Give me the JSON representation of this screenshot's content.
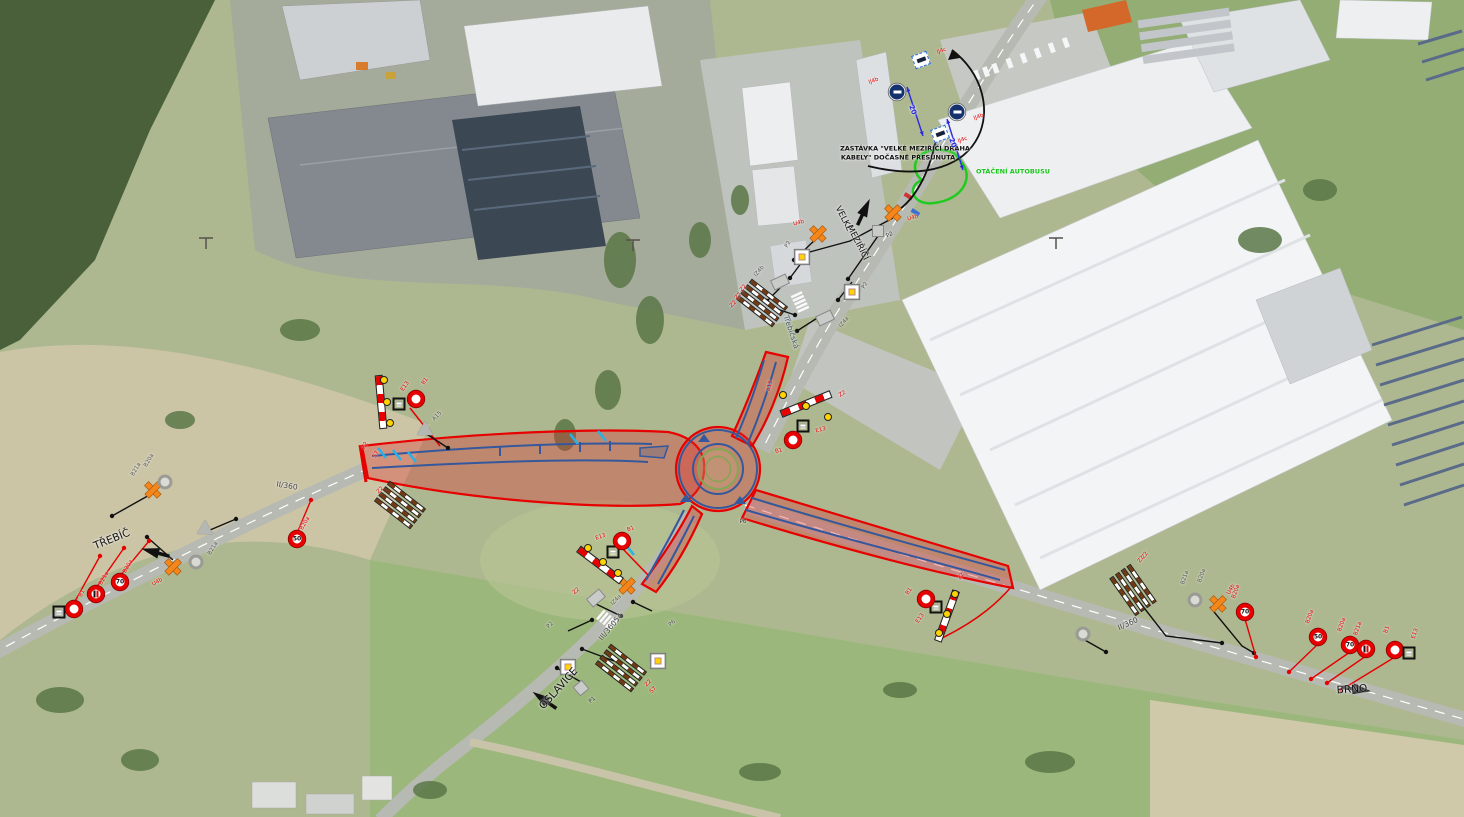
{
  "map": {
    "notes": {
      "bus_stop_line1": "ZASTÁVKA \"VELKÉ MEZIŘÍČÍ DRÁHA",
      "bus_stop_line2": "KABELY\" DOČASNĚ PŘESUNUTA",
      "bus_turning": "OTÁČENÍ AUTOBUSU"
    },
    "destinations": {
      "west": "TŘEBÍČ",
      "south": "OSLAVICE",
      "east": "BRNO",
      "north_line1": "VELKÉ",
      "north_line2": "MEZIŘÍČÍ"
    },
    "roads": {
      "west": "II/360",
      "east": "II/360",
      "south": "III/36054",
      "street": "Třebíčská"
    },
    "dimension_value": "20",
    "colors": {
      "closure_zone": "#e60000",
      "lane_marking": "#35589c",
      "temp_device": "#f5861c",
      "bus_note": "#16c518"
    }
  },
  "labels": [
    {
      "t": "ZASTÁVKA \"VELKÉ MEZIŘÍČÍ DRÁHA",
      "x": 905,
      "y": 149,
      "r": 0,
      "c": "#111",
      "f": 6.5,
      "w": 700
    },
    {
      "t": "KABELY\" DOČASNĚ PŘESUNUTA",
      "x": 898,
      "y": 158,
      "r": 0,
      "c": "#111",
      "f": 6.5,
      "w": 700
    },
    {
      "t": "OTÁČENÍ AUTOBUSU",
      "x": 1013,
      "y": 172,
      "r": 0,
      "c": "#16c518",
      "f": 6.5,
      "w": 700
    },
    {
      "t": "VELKÉ",
      "x": 843,
      "y": 219,
      "r": 63,
      "c": "#111",
      "f": 8.5,
      "w": 400
    },
    {
      "t": "MEZIŘÍČÍ",
      "x": 857,
      "y": 243,
      "r": 63,
      "c": "#111",
      "f": 8.5,
      "w": 400
    },
    {
      "t": "Třebíčská",
      "x": 791,
      "y": 332,
      "r": 72,
      "c": "#45566b",
      "f": 7.5,
      "w": 400
    },
    {
      "t": "TŘEBÍČ",
      "x": 112,
      "y": 540,
      "r": -22,
      "c": "#111",
      "f": 10.5,
      "w": 400
    },
    {
      "t": "OSLAVICE",
      "x": 559,
      "y": 689,
      "r": -48,
      "c": "#111",
      "f": 10.5,
      "w": 400
    },
    {
      "t": "BRNO",
      "x": 1352,
      "y": 690,
      "r": -4,
      "c": "#111",
      "f": 10.5,
      "w": 400
    },
    {
      "t": "II/360",
      "x": 287,
      "y": 486,
      "r": 9,
      "c": "#444",
      "f": 7.5,
      "w": 400
    },
    {
      "t": "II/360",
      "x": 1128,
      "y": 624,
      "r": -24,
      "c": "#444",
      "f": 7.5,
      "w": 400
    },
    {
      "t": "III/36054",
      "x": 611,
      "y": 627,
      "r": -50,
      "c": "#444",
      "f": 7.5,
      "w": 400
    },
    {
      "t": "20",
      "x": 912,
      "y": 110,
      "r": 70,
      "c": "#2a2ae0",
      "f": 7,
      "w": 700
    },
    {
      "t": "20",
      "x": 952,
      "y": 143,
      "r": 70,
      "c": "#2a2ae0",
      "f": 7,
      "w": 700
    },
    {
      "t": "P2",
      "x": 890,
      "y": 236,
      "r": -25,
      "c": "#333",
      "f": 5.5,
      "w": 400
    },
    {
      "t": "P6",
      "x": 743,
      "y": 523,
      "r": 0,
      "c": "#333",
      "f": 5.5,
      "w": 400
    },
    {
      "t": "P1",
      "x": 593,
      "y": 701,
      "r": -40,
      "c": "#333",
      "f": 5.5,
      "w": 400
    },
    {
      "t": "S7",
      "x": 377,
      "y": 455,
      "r": -60,
      "c": "#e60000",
      "f": 5.5,
      "w": 400
    },
    {
      "t": "A15",
      "x": 771,
      "y": 386,
      "r": -80,
      "c": "#e60000",
      "f": 5.5,
      "w": 400
    },
    {
      "t": "B20a",
      "x": 150,
      "y": 461,
      "r": -60,
      "c": "#555",
      "f": 5.5,
      "w": 400
    },
    {
      "t": "B21a",
      "x": 137,
      "y": 470,
      "r": -60,
      "c": "#555",
      "f": 5.5,
      "w": 400
    },
    {
      "t": "B21a",
      "x": 214,
      "y": 549,
      "r": -60,
      "c": "#555",
      "f": 5.5,
      "w": 400
    },
    {
      "t": "B21a",
      "x": 1186,
      "y": 578,
      "r": -70,
      "c": "#555",
      "f": 5.5,
      "w": 400
    },
    {
      "t": "B20a",
      "x": 1203,
      "y": 576,
      "r": -70,
      "c": "#555",
      "f": 5.5,
      "w": 400
    },
    {
      "t": "Z2",
      "x": 739,
      "y": 297,
      "r": -45,
      "c": "#e60000",
      "f": 5.5,
      "w": 400
    },
    {
      "t": "Z2",
      "x": 734,
      "y": 305,
      "r": -45,
      "c": "#e60000",
      "f": 5.5,
      "w": 400
    },
    {
      "t": "Z2",
      "x": 1146,
      "y": 556,
      "r": -55,
      "c": "#e60000",
      "f": 5.5,
      "w": 400
    },
    {
      "t": "S7",
      "x": 654,
      "y": 691,
      "r": -45,
      "c": "#e60000",
      "f": 5.5,
      "w": 400
    }
  ],
  "signs": [
    {
      "t": "ij4c",
      "x": 921,
      "y": 60,
      "r": -20,
      "l": "IJ4c",
      "lx": 942,
      "ly": 52,
      "lr": -20,
      "lc": "#e60000"
    },
    {
      "t": "ij4b",
      "x": 897,
      "y": 92,
      "l": "IJ4b",
      "lx": 874,
      "ly": 82,
      "lr": -20,
      "lc": "#e60000"
    },
    {
      "t": "ij4b",
      "x": 957,
      "y": 112,
      "l": "IJ4b",
      "lx": 979,
      "ly": 118,
      "lr": -20,
      "lc": "#e60000"
    },
    {
      "t": "ij4c",
      "x": 940,
      "y": 134,
      "r": -20,
      "l": "IJ4c",
      "lx": 963,
      "ly": 141,
      "lr": -20,
      "lc": "#e60000"
    },
    {
      "t": "u4b",
      "x": 893,
      "y": 212,
      "l": "U4b",
      "lx": 913,
      "ly": 219,
      "lr": -15,
      "lc": "#e60000"
    },
    {
      "t": "u4b",
      "x": 818,
      "y": 233,
      "l": "U4b",
      "lx": 799,
      "ly": 224,
      "lr": -15,
      "lc": "#e60000"
    },
    {
      "t": "u4b",
      "x": 153,
      "y": 489
    },
    {
      "t": "u4b",
      "x": 173,
      "y": 566,
      "l": "U4b",
      "lx": 158,
      "ly": 583,
      "lr": -30,
      "lc": "#e60000"
    },
    {
      "t": "u4b",
      "x": 1218,
      "y": 603,
      "l": "U4b",
      "lx": 1232,
      "ly": 590,
      "lr": -60,
      "lc": "#e60000"
    },
    {
      "t": "u4b",
      "x": 627,
      "y": 585
    },
    {
      "t": "grey-circle",
      "x": 165,
      "y": 482
    },
    {
      "t": "grey-circle",
      "x": 196,
      "y": 562
    },
    {
      "t": "grey-circle",
      "x": 1195,
      "y": 600
    },
    {
      "t": "grey-circle",
      "x": 1083,
      "y": 634
    },
    {
      "t": "grey-square",
      "x": 878,
      "y": 231
    },
    {
      "t": "grey-rect",
      "x": 825,
      "y": 318,
      "r": -25,
      "l": "IZ4a",
      "lx": 845,
      "ly": 323,
      "lr": -50,
      "lc": "#555"
    },
    {
      "t": "grey-rect",
      "x": 780,
      "y": 282,
      "r": -25,
      "l": "IZ4b",
      "lx": 760,
      "ly": 272,
      "lr": -50,
      "lc": "#555"
    },
    {
      "t": "grey-rect",
      "x": 596,
      "y": 598,
      "r": -40,
      "l": "IZ4a",
      "lx": 617,
      "ly": 601,
      "lr": -45,
      "lc": "#555"
    },
    {
      "t": "grey-square",
      "x": 581,
      "y": 688,
      "r": -40
    },
    {
      "t": "grey-tri",
      "x": 425,
      "y": 428,
      "l": "A15",
      "lx": 438,
      "ly": 417,
      "lr": -45,
      "lc": "#555"
    },
    {
      "t": "grey-tri",
      "x": 205,
      "y": 527
    },
    {
      "t": "p2",
      "x": 802,
      "y": 257,
      "l": "P2",
      "lx": 789,
      "ly": 245,
      "lr": -60,
      "lc": "#555"
    },
    {
      "t": "p2",
      "x": 852,
      "y": 277,
      "l": "P2",
      "lx": 866,
      "ly": 286,
      "lr": -60,
      "lc": "#555"
    },
    {
      "t": "p2",
      "x": 568,
      "y": 637,
      "l": "P2",
      "lx": 551,
      "ly": 626,
      "lr": -45,
      "lc": "#555"
    },
    {
      "t": "p2",
      "x": 658,
      "y": 616,
      "l": "P6",
      "lx": 673,
      "ly": 624,
      "lr": -45,
      "lc": "#555"
    },
    {
      "t": "z2bar",
      "x": 381,
      "y": 402,
      "r": 85,
      "l": "Z2",
      "lx": 366,
      "ly": 446,
      "lr": -60,
      "lc": "#e60000"
    },
    {
      "t": "lamp",
      "x": 384,
      "y": 380
    },
    {
      "t": "lamp",
      "x": 387,
      "y": 402
    },
    {
      "t": "lamp",
      "x": 390,
      "y": 423
    },
    {
      "t": "e13",
      "x": 399,
      "y": 404,
      "l": "E13",
      "lx": 406,
      "ly": 387,
      "lr": -55,
      "lc": "#e60000"
    },
    {
      "t": "b1",
      "x": 416,
      "y": 399,
      "l": "B1",
      "lx": 426,
      "ly": 382,
      "lr": -55,
      "lc": "#e60000"
    },
    {
      "t": "z2bar",
      "x": 806,
      "y": 404,
      "r": -22,
      "l": "Z2",
      "lx": 843,
      "ly": 395,
      "lr": -30,
      "lc": "#e60000"
    },
    {
      "t": "lamp",
      "x": 783,
      "y": 395
    },
    {
      "t": "lamp",
      "x": 806,
      "y": 406
    },
    {
      "t": "lamp",
      "x": 828,
      "y": 417
    },
    {
      "t": "e13",
      "x": 803,
      "y": 426,
      "l": "E13",
      "lx": 821,
      "ly": 431,
      "lr": -15,
      "lc": "#e60000"
    },
    {
      "t": "b1",
      "x": 793,
      "y": 440,
      "l": "B1",
      "lx": 779,
      "ly": 452,
      "lr": -15,
      "lc": "#e60000"
    },
    {
      "t": "z2bar",
      "x": 600,
      "y": 565,
      "r": 37,
      "l": "Z2",
      "lx": 577,
      "ly": 592,
      "lr": -40,
      "lc": "#e60000"
    },
    {
      "t": "lamp",
      "x": 588,
      "y": 548
    },
    {
      "t": "lamp",
      "x": 603,
      "y": 562
    },
    {
      "t": "lamp",
      "x": 618,
      "y": 573
    },
    {
      "t": "e13",
      "x": 613,
      "y": 552,
      "l": "E13",
      "lx": 601,
      "ly": 538,
      "lr": -20,
      "lc": "#e60000"
    },
    {
      "t": "b1",
      "x": 622,
      "y": 541,
      "l": "B1",
      "lx": 631,
      "ly": 530,
      "lr": -20,
      "lc": "#e60000"
    },
    {
      "t": "z2bar",
      "x": 947,
      "y": 616,
      "r": 110,
      "l": "Z2",
      "lx": 962,
      "ly": 577,
      "lr": -55,
      "lc": "#e60000"
    },
    {
      "t": "lamp",
      "x": 955,
      "y": 594
    },
    {
      "t": "lamp",
      "x": 947,
      "y": 614
    },
    {
      "t": "lamp",
      "x": 939,
      "y": 633
    },
    {
      "t": "e13",
      "x": 936,
      "y": 607,
      "l": "E13",
      "lx": 921,
      "ly": 619,
      "lr": -55,
      "lc": "#e60000"
    },
    {
      "t": "b1",
      "x": 926,
      "y": 599,
      "l": "B1",
      "lx": 910,
      "ly": 592,
      "lr": -55,
      "lc": "#e60000"
    },
    {
      "t": "e13",
      "x": 59,
      "y": 612
    },
    {
      "t": "b1",
      "x": 74,
      "y": 609,
      "l": "B1",
      "lx": 83,
      "ly": 594,
      "lr": -60,
      "lc": "#e60000"
    },
    {
      "t": "b21a",
      "x": 96,
      "y": 594,
      "l": "B21a",
      "lx": 105,
      "ly": 579,
      "lr": -60,
      "lc": "#e60000"
    },
    {
      "t": "b20a",
      "v": "70",
      "x": 120,
      "y": 582,
      "l": "B20a",
      "lx": 129,
      "ly": 567,
      "lr": -60,
      "lc": "#e60000"
    },
    {
      "t": "b20a",
      "v": "50",
      "x": 297,
      "y": 539,
      "l": "B20a",
      "lx": 306,
      "ly": 524,
      "lr": -60,
      "lc": "#e60000"
    },
    {
      "t": "b20a",
      "v": "50",
      "x": 1318,
      "y": 637,
      "l": "B20a",
      "lx": 1311,
      "ly": 617,
      "lr": -70,
      "lc": "#e60000"
    },
    {
      "t": "b20a",
      "v": "70",
      "x": 1350,
      "y": 645,
      "l": "B20a",
      "lx": 1343,
      "ly": 625,
      "lr": -70,
      "lc": "#e60000"
    },
    {
      "t": "b21a",
      "x": 1366,
      "y": 649,
      "l": "B21a",
      "lx": 1359,
      "ly": 629,
      "lr": -70,
      "lc": "#e60000"
    },
    {
      "t": "b1",
      "x": 1395,
      "y": 650,
      "l": "B1",
      "lx": 1388,
      "ly": 630,
      "lr": -70,
      "lc": "#e60000"
    },
    {
      "t": "e13",
      "x": 1409,
      "y": 653,
      "l": "E13",
      "lx": 1416,
      "ly": 634,
      "lr": -70,
      "lc": "#e60000"
    },
    {
      "t": "b20a",
      "v": "70",
      "x": 1245,
      "y": 612,
      "l": "B20a",
      "lx": 1237,
      "ly": 592,
      "lr": -70,
      "lc": "#e60000"
    },
    {
      "t": "z2boards",
      "x": 762,
      "y": 303,
      "r": 38,
      "l": "Z2",
      "lx": 744,
      "ly": 289,
      "lr": -45,
      "lc": "#e60000"
    },
    {
      "t": "z2boards",
      "x": 400,
      "y": 505,
      "r": 38,
      "l": "Z2",
      "lx": 381,
      "ly": 491,
      "lr": -45,
      "lc": "#e60000"
    },
    {
      "t": "z2boards",
      "x": 621,
      "y": 668,
      "r": 38,
      "l": "Z2",
      "lx": 649,
      "ly": 684,
      "lr": -45,
      "lc": "#e60000"
    },
    {
      "t": "z2boards",
      "x": 1133,
      "y": 590,
      "r": 55,
      "l": "Z2",
      "lx": 1142,
      "ly": 560,
      "lr": -55,
      "lc": "#e60000"
    }
  ],
  "leaders": [
    {
      "c": "#111",
      "p": [
        [
          893,
          218
        ],
        [
          850,
          241
        ],
        [
          806,
          253
        ]
      ]
    },
    {
      "c": "#111",
      "p": [
        [
          818,
          237
        ],
        [
          794,
          260
        ]
      ]
    },
    {
      "c": "#111",
      "p": [
        [
          878,
          236
        ],
        [
          848,
          279
        ]
      ]
    },
    {
      "c": "#111",
      "p": [
        [
          825,
          313
        ],
        [
          797,
          331
        ]
      ]
    },
    {
      "c": "#111",
      "p": [
        [
          780,
          288
        ],
        [
          767,
          301
        ]
      ]
    },
    {
      "c": "#111",
      "p": [
        [
          768,
          306
        ],
        [
          795,
          315
        ]
      ]
    },
    {
      "c": "#111",
      "p": [
        [
          596,
          604
        ],
        [
          621,
          616
        ]
      ]
    },
    {
      "c": "#111",
      "p": [
        [
          568,
          631
        ],
        [
          592,
          620
        ]
      ]
    },
    {
      "c": "#111",
      "p": [
        [
          652,
          611
        ],
        [
          633,
          602
        ]
      ]
    },
    {
      "c": "#111",
      "p": [
        [
          581,
          682
        ],
        [
          557,
          668
        ]
      ]
    },
    {
      "c": "#111",
      "p": [
        [
          614,
          661
        ],
        [
          582,
          649
        ]
      ]
    },
    {
      "c": "#111",
      "p": [
        [
          1138,
          600
        ],
        [
          1166,
          636
        ],
        [
          1222,
          643
        ]
      ]
    },
    {
      "c": "#111",
      "p": [
        [
          1210,
          607
        ],
        [
          1242,
          646
        ],
        [
          1254,
          653
        ]
      ]
    },
    {
      "c": "#111",
      "p": [
        [
          173,
          560
        ],
        [
          147,
          537
        ]
      ]
    },
    {
      "c": "#111",
      "p": [
        [
          153,
          493
        ],
        [
          112,
          516
        ]
      ]
    },
    {
      "c": "#111",
      "p": [
        [
          210,
          530
        ],
        [
          236,
          519
        ]
      ]
    },
    {
      "c": "#111",
      "p": [
        [
          425,
          433
        ],
        [
          448,
          448
        ]
      ]
    },
    {
      "c": "#111",
      "p": [
        [
          1083,
          639
        ],
        [
          1106,
          652
        ]
      ]
    },
    {
      "c": "#111",
      "p": [
        [
          852,
          282
        ],
        [
          838,
          300
        ]
      ]
    },
    {
      "c": "#111",
      "p": [
        [
          802,
          262
        ],
        [
          790,
          278
        ]
      ]
    },
    {
      "c": "#e60000",
      "p": [
        [
          74,
          603
        ],
        [
          100,
          556
        ]
      ]
    },
    {
      "c": "#e60000",
      "p": [
        [
          96,
          588
        ],
        [
          124,
          548
        ]
      ]
    },
    {
      "c": "#e60000",
      "p": [
        [
          120,
          576
        ],
        [
          149,
          541
        ]
      ]
    },
    {
      "c": "#e60000",
      "p": [
        [
          297,
          533
        ],
        [
          311,
          500
        ]
      ]
    },
    {
      "c": "#e60000",
      "p": [
        [
          1318,
          644
        ],
        [
          1289,
          672
        ]
      ]
    },
    {
      "c": "#e60000",
      "p": [
        [
          1350,
          652
        ],
        [
          1311,
          679
        ]
      ]
    },
    {
      "c": "#e60000",
      "p": [
        [
          1366,
          656
        ],
        [
          1327,
          683
        ]
      ]
    },
    {
      "c": "#e60000",
      "p": [
        [
          1395,
          657
        ],
        [
          1341,
          690
        ]
      ]
    },
    {
      "c": "#e60000",
      "p": [
        [
          1245,
          619
        ],
        [
          1256,
          657
        ]
      ]
    }
  ],
  "dimensions": [
    {
      "c": "#2a2ae0",
      "p": [
        [
          907,
          87
        ],
        [
          923,
          136
        ]
      ]
    },
    {
      "c": "#2a2ae0",
      "p": [
        [
          947,
          119
        ],
        [
          963,
          170
        ]
      ]
    }
  ],
  "arrows": [
    {
      "x": 150,
      "y": 551,
      "r": 195
    },
    {
      "x": 1362,
      "y": 690,
      "r": 8
    },
    {
      "x": 540,
      "y": 697,
      "r": 215
    },
    {
      "x": 866,
      "y": 207,
      "r": -65
    }
  ]
}
